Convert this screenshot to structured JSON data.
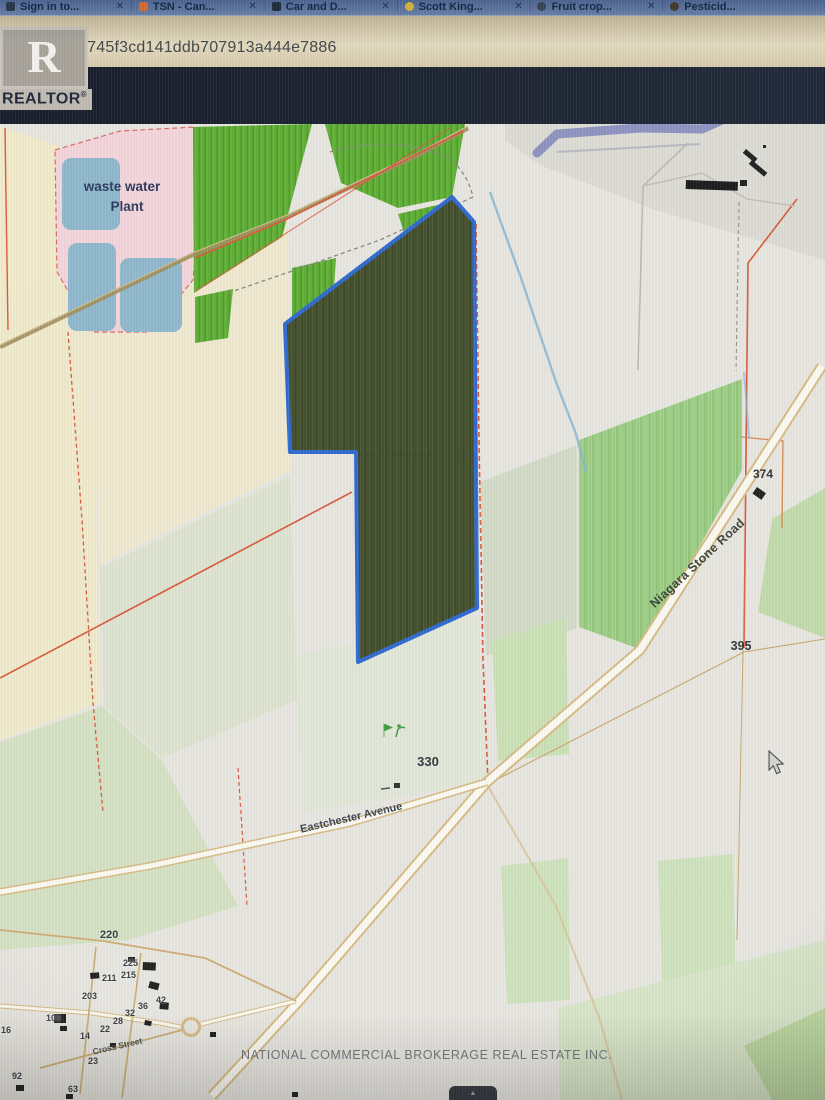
{
  "browser": {
    "tabs": [
      {
        "label": "Sign in to...",
        "close": "✕"
      },
      {
        "label": "TSN - Can...",
        "close": "✕"
      },
      {
        "label": "Car and D...",
        "close": "✕"
      },
      {
        "label": "Scott King...",
        "close": "✕"
      },
      {
        "label": "Fruit crop...",
        "close": "✕"
      },
      {
        "label": "Pesticid...",
        "close": ""
      }
    ],
    "url_text": "ml?id=4500745f3cd141ddb707913a444e7886"
  },
  "logo": {
    "letter": "R",
    "wordmark": "REALTOR",
    "registered": "®"
  },
  "map": {
    "place_labels": {
      "waste_water_1": "waste water",
      "waste_water_2": "Plant",
      "niagara_stone_road": "Niagara Stone Road",
      "eastchester_avenue": "Eastchester Avenue",
      "cross_street": "Cross Street"
    },
    "lot_numbers": {
      "n374": "374",
      "n395": "395",
      "n330": "330",
      "n220": "220"
    },
    "house_numbers": [
      "225",
      "215",
      "211",
      "203",
      "106",
      "16",
      "42",
      "36",
      "32",
      "28",
      "22",
      "14",
      "23",
      "92",
      "63"
    ],
    "watermark": "NATIONAL COMMERCIAL BROKERAGE REAL ESTATE INC.",
    "colors": {
      "highlight_fill": "#47542e",
      "highlight_border": "#2e6bd6",
      "boundary_orange": "#e0553a",
      "orchard_green": "#5fb334",
      "field_green": "#9ed186",
      "water_blue": "#8fb9cf",
      "plant_pink": "#f5d6dc"
    }
  },
  "controls": {
    "bottom_tab_glyph": "▲"
  }
}
